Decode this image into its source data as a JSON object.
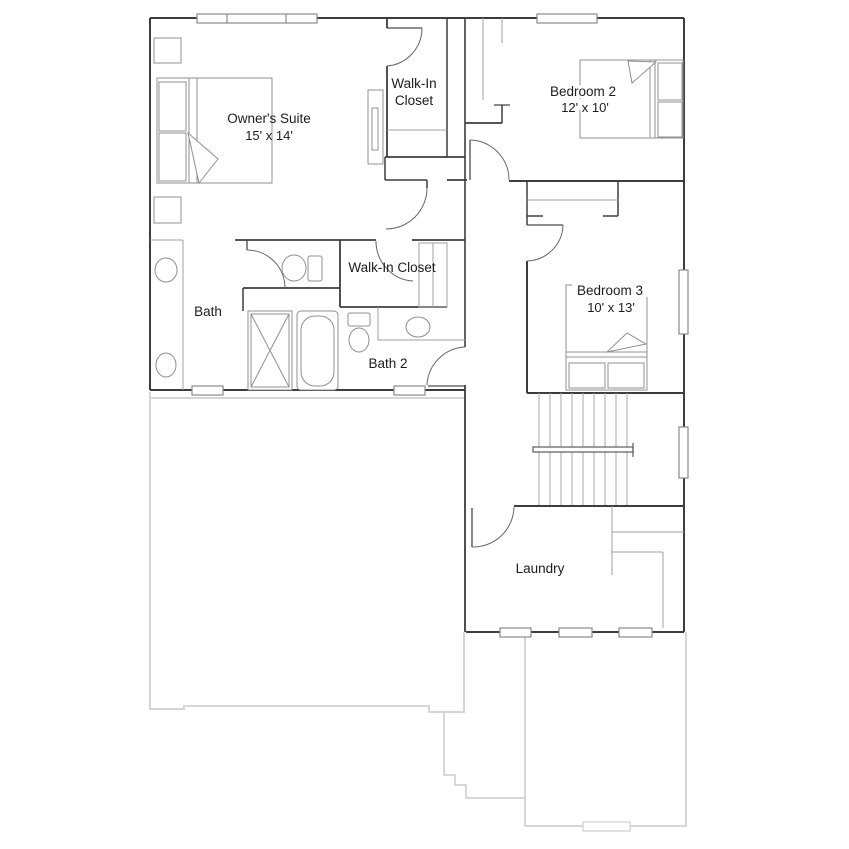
{
  "plan": {
    "rooms": [
      {
        "name": "Owner's Suite",
        "dims": "15' x 14'"
      },
      {
        "name": "Walk-In Closet",
        "line1": "Walk-In",
        "line2": "Closet"
      },
      {
        "name": "Bedroom 2",
        "dims": "12' x 10'"
      },
      {
        "name": "Bath"
      },
      {
        "name": "Walk-In Closet"
      },
      {
        "name": "Bath 2"
      },
      {
        "name": "Bedroom 3",
        "dims": "10' x 13'"
      },
      {
        "name": "Laundry"
      }
    ],
    "colors": {
      "wall": "#3d3d3d",
      "door": "#666666",
      "fixture": "#909090",
      "stair_tread": "#aaaaaa",
      "first_floor_outline": "#d6d6d6",
      "label_text": "#1c1c1c"
    }
  }
}
